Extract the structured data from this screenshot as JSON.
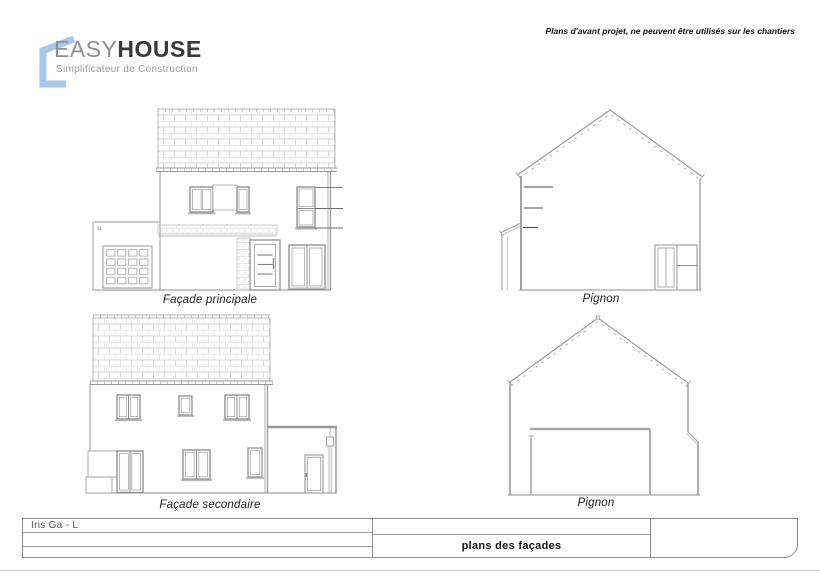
{
  "header": {
    "disclaimer": "Plans d'avant projet, ne peuvent être utilisés sur les chantiers",
    "logo": {
      "brand_light": "EASY",
      "brand_bold": "HOUSE",
      "tagline": "Simplificateur de Construction",
      "icon": "house-outline-icon",
      "accent_color": "#a9c7e8"
    }
  },
  "drawings": {
    "facade_principale": {
      "label": "Façade principale"
    },
    "pignon_top": {
      "label": "Pignon"
    },
    "facade_secondaire": {
      "label": "Façade secondaire"
    },
    "pignon_bottom": {
      "label": "Pignon"
    }
  },
  "title_block": {
    "project_ref": "Iris Ga - L",
    "sheet_title": "plans des façades"
  },
  "colors": {
    "drawing_line": "#8f8f8f",
    "hatch_line": "#c9c9c9",
    "accent_blue": "#a9c7e8",
    "brand_dark": "#3a3a3a",
    "brand_gray": "#9a9a9a"
  }
}
